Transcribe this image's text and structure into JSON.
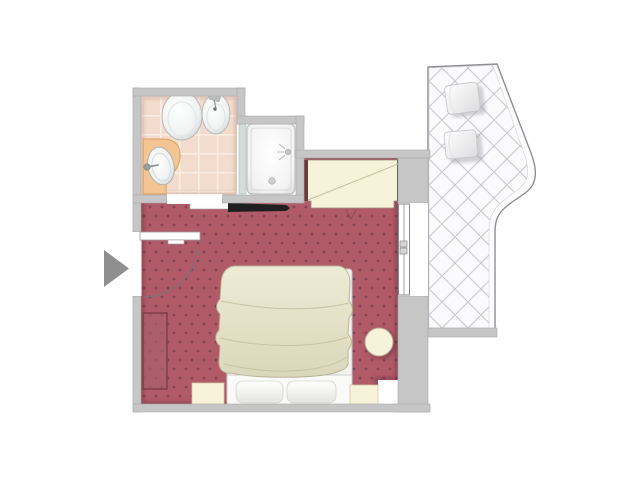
{
  "document": {
    "type": "floor-plan",
    "subject": "hotel guest room with bathroom and terrace",
    "canvas": {
      "width": 640,
      "height": 480
    }
  },
  "palette": {
    "background": "#ffffff",
    "wall": "#c6c6c6",
    "wall_edge": "#a9a9a9",
    "carpet": "#b15a68",
    "carpet_dot": "#7d4050",
    "tile": "#f3dccd",
    "tile_grout": "#fcede4",
    "counter": "#f4c493",
    "cream": "#f7f2da",
    "wood": "#6f3a38",
    "blanket": "#e6e3c9",
    "lattice_line": "#c6c6ce",
    "railing": "#8f8f8f",
    "arrow": "#8f8f8f",
    "tv": "#1f1f1f",
    "radiator": "#a9636c",
    "shower_glass": "#d3dcd6"
  },
  "rooms": {
    "bathroom": {
      "name": "bathroom",
      "floor": "tiled",
      "fixtures": [
        "toilet",
        "bidet",
        "washbasin with counter",
        "shower tray"
      ]
    },
    "bedroom": {
      "name": "bedroom",
      "floor": "patterned carpet",
      "furniture": [
        "entry door",
        "double bed",
        "two pillows",
        "left nightstand",
        "right nightstand",
        "round side table",
        "wardrobe",
        "tv shelf",
        "radiator"
      ]
    },
    "terrace": {
      "name": "terrace",
      "floor": "diagonal lattice tiles",
      "furniture": [
        "seat cushion 1",
        "seat cushion 2"
      ],
      "access": "sliding glass door"
    }
  },
  "markers": {
    "entrance_arrow": {
      "shape": "triangle",
      "direction": "right"
    }
  }
}
